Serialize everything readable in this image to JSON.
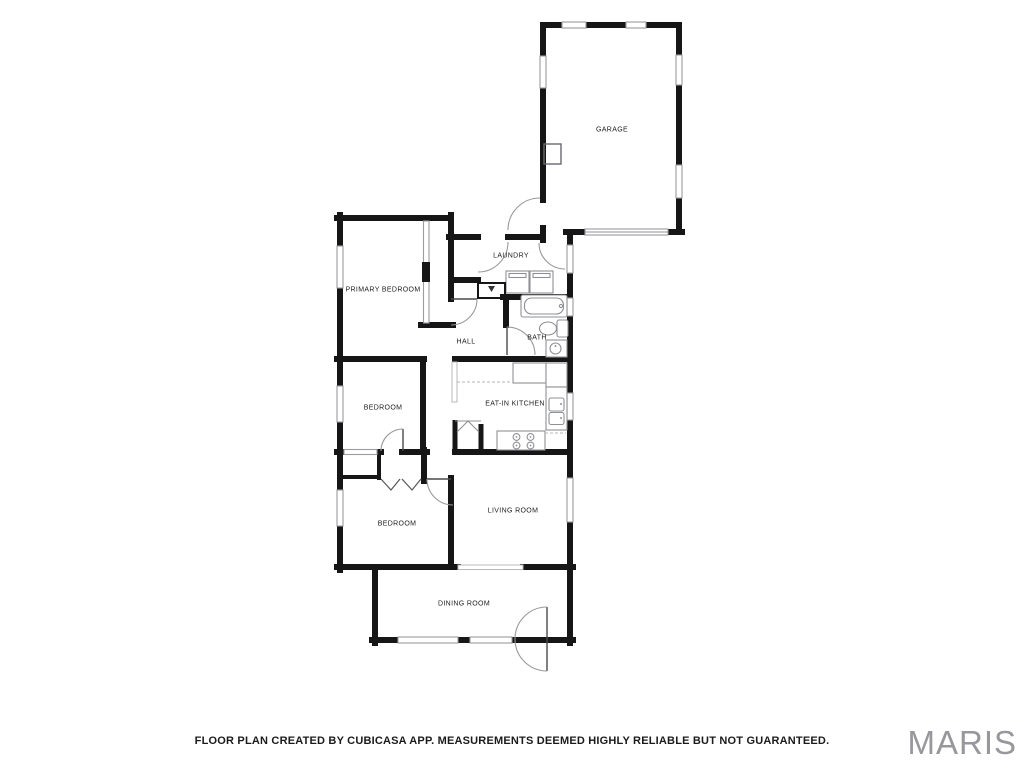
{
  "rooms": {
    "garage": "GARAGE",
    "laundry": "LAUNDRY",
    "primary_bedroom": "PRIMARY BEDROOM",
    "hall": "HALL",
    "bath": "BATH",
    "eat_in_kitchen": "EAT-IN KITCHEN",
    "bedroom_middle": "BEDROOM",
    "bedroom_lower": "BEDROOM",
    "living_room": "LIVING ROOM",
    "dining_room": "DINING ROOM"
  },
  "footer": {
    "disclaimer": "FLOOR PLAN CREATED BY CUBICASA APP. MEASUREMENTS DEEMED HIGHLY RELIABLE BUT NOT GUARANTEED."
  },
  "watermark": {
    "text": "MARIS"
  },
  "plan": {
    "background": "#ffffff",
    "wall_color": "#161616",
    "window_color": "#9a9ca0",
    "door_arc_color": "#9a9a9a",
    "fixture_color": "#8f9094",
    "label_color": "#1c1c1c",
    "watermark_color": "#97979c",
    "fixtures": [
      "bathtub",
      "toilet",
      "bath-sink",
      "washer",
      "dryer",
      "water-heater",
      "refrigerator",
      "kitchen-counter",
      "kitchen-sink",
      "range",
      "pantry-bifold",
      "closet-bifold",
      "garage-storage"
    ]
  }
}
